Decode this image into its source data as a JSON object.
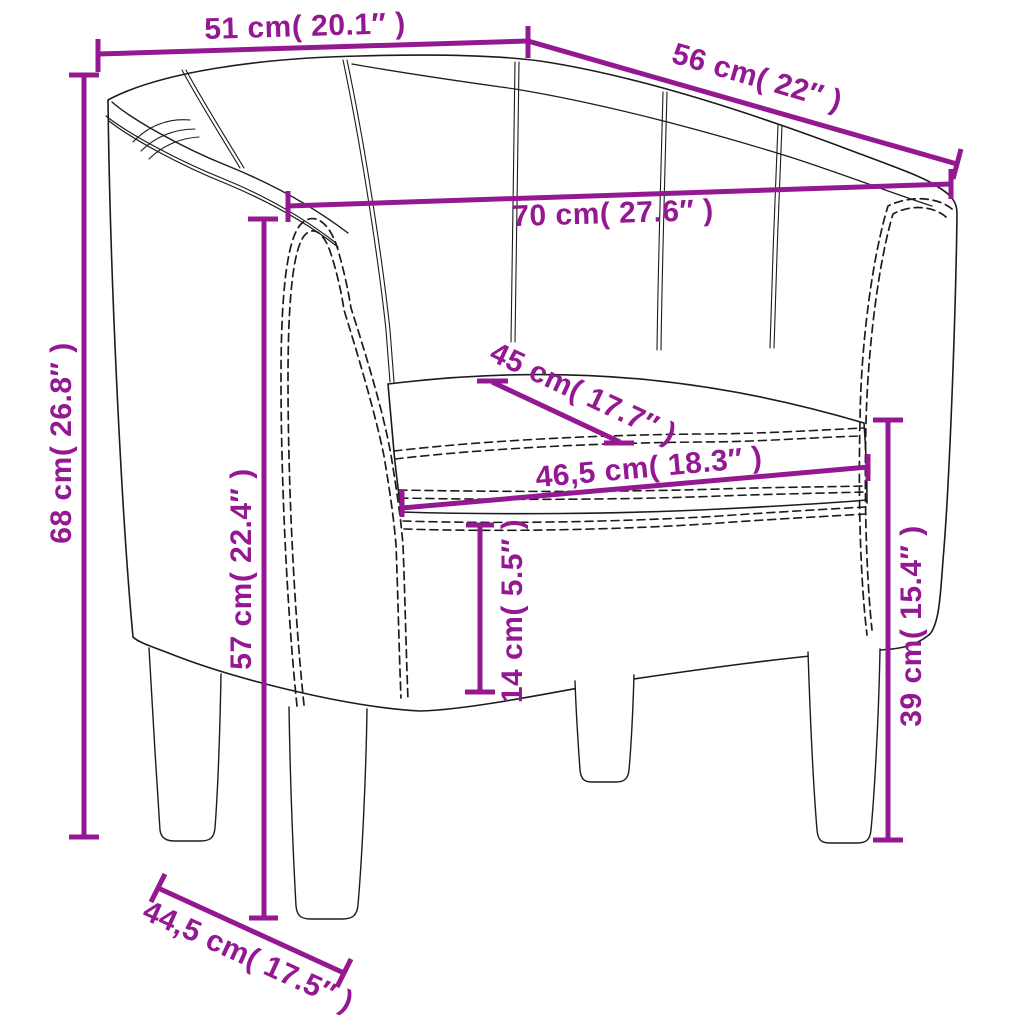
{
  "figure": {
    "kind": "product-dimension-diagram",
    "subject": "tub-armchair-line-drawing"
  },
  "colors": {
    "dimension_line": "#941892",
    "line_art": "#1c1c1c",
    "background": "#ffffff"
  },
  "measurements": {
    "top_width": {
      "label": "51 cm( 20.1″ )",
      "cm": "51",
      "inches": "20.1"
    },
    "top_depth": {
      "label": "56 cm( 22″ )",
      "cm": "56",
      "inches": "22"
    },
    "inner_width": {
      "label": "70 cm( 27.6″ )",
      "cm": "70",
      "inches": "27.6"
    },
    "seat_depth": {
      "label": "45 cm( 17.7″ )",
      "cm": "45",
      "inches": "17.7"
    },
    "seat_width": {
      "label": "46,5 cm( 18.3″ )",
      "cm": "46,5",
      "inches": "18.3"
    },
    "total_height": {
      "label": "68 cm( 26.8″ )",
      "cm": "68",
      "inches": "26.8"
    },
    "front_height": {
      "label": "57 cm( 22.4″ )",
      "cm": "57",
      "inches": "22.4"
    },
    "base_height": {
      "label": "14 cm( 5.5″ )",
      "cm": "14",
      "inches": "5.5"
    },
    "side_height": {
      "label": "39 cm( 15.4″ )",
      "cm": "39",
      "inches": "15.4"
    },
    "base_depth": {
      "label": "44,5 cm( 17.5″ )",
      "cm": "44,5",
      "inches": "17.5"
    }
  }
}
